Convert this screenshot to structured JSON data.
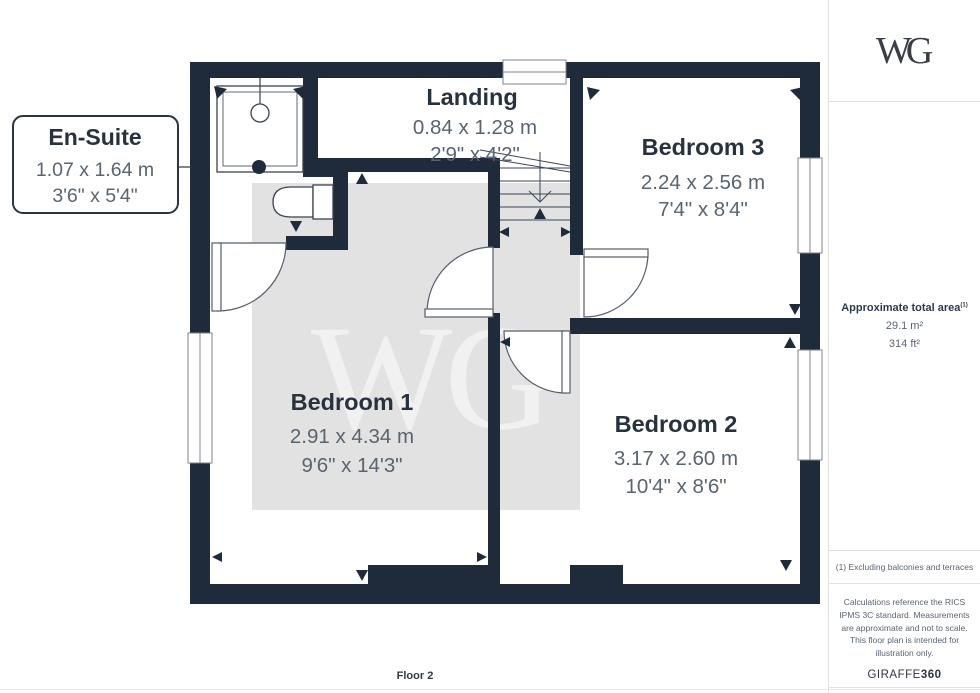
{
  "logo": {
    "text": "WG"
  },
  "watermark": {
    "text": "WG"
  },
  "floor_label": "Floor 2",
  "rooms": {
    "ensuite": {
      "name": "En-Suite",
      "metric": "1.07 x 1.64 m",
      "imperial": "3'6\" x 5'4\""
    },
    "landing": {
      "name": "Landing",
      "metric": "0.84 x 1.28 m",
      "imperial": "2'9\" x 4'2\""
    },
    "bedroom1": {
      "name": "Bedroom 1",
      "metric": "2.91 x 4.34 m",
      "imperial": "9'6\" x 14'3\""
    },
    "bedroom2": {
      "name": "Bedroom 2",
      "metric": "3.17 x 2.60 m",
      "imperial": "10'4\" x 8'6\""
    },
    "bedroom3": {
      "name": "Bedroom 3",
      "metric": "2.24 x 2.56 m",
      "imperial": "7'4\" x 8'4\""
    }
  },
  "sidebar": {
    "area_title": "Approximate total area",
    "area_superscript": "(1)",
    "area_m2": "29.1 m²",
    "area_ft2": "314 ft²",
    "footnote": "(1) Excluding balconies and terraces",
    "disclaimer": "Calculations reference the RICS IPMS 3C standard. Measurements are approximate and not to scale. This floor plan is intended for illustration only.",
    "brand_name": "GIRAFFE",
    "brand_number": "360"
  },
  "colors": {
    "wall": "#1f2b3a",
    "room_name_text": "#28323f",
    "dimension_text": "#596470",
    "watermark_area": "#e2e2e2",
    "sidebar_border": "#e0e0e0"
  }
}
